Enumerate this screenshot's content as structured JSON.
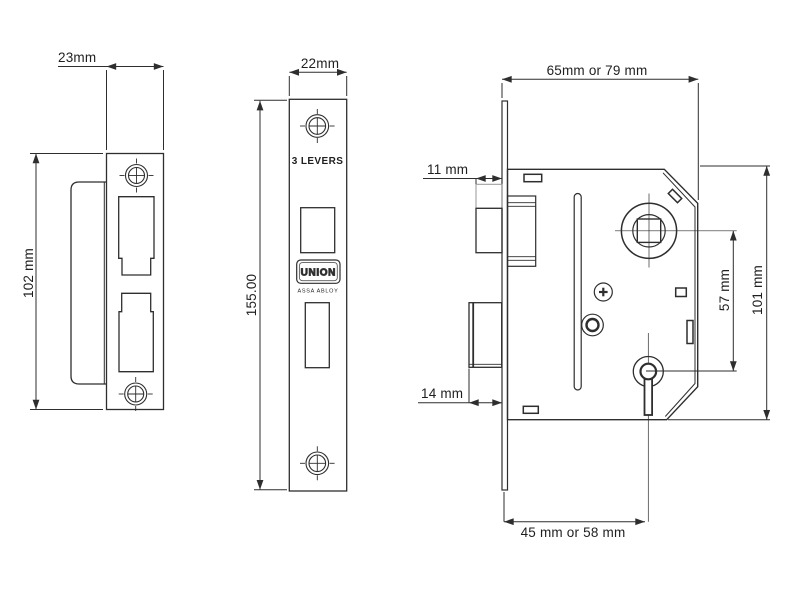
{
  "drawing": {
    "title_hint": "mortice lock technical drawing",
    "background": "#ffffff",
    "line_color": "#2e2e2e",
    "keep_view": {
      "width_label": "23mm",
      "height_label": "102 mm"
    },
    "faceplate_view": {
      "width_label": "22mm",
      "height_label": "155.00",
      "levers_label": "3 LEVERS",
      "brand": "UNION",
      "brand_sub": "ASSA ABLOY"
    },
    "case_view": {
      "width_label": "65mm or 79 mm",
      "latch_depth_label": "11 mm",
      "bolt_depth_label": "14 mm",
      "centres_label": "57 mm",
      "height_label": "101 mm",
      "backset_label": "45 mm or 58 mm"
    }
  }
}
